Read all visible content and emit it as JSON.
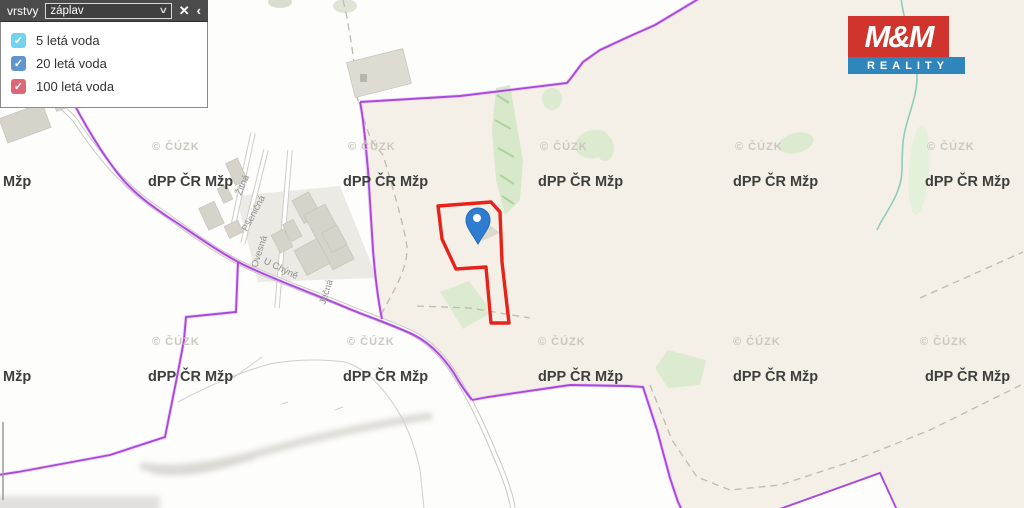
{
  "panel": {
    "title": "vrstvy",
    "dropdown": {
      "value": "záplav",
      "chevron": "∨"
    },
    "close_icon": "✕",
    "collapse_icon": "‹",
    "checkmark": "✓",
    "layers": [
      {
        "label": "5 letá voda",
        "checked": true,
        "color": "#72d3ee"
      },
      {
        "label": "20 letá voda",
        "checked": true,
        "color": "#6096cb"
      },
      {
        "label": "100 letá voda",
        "checked": true,
        "color": "#dd6777"
      }
    ]
  },
  "logo": {
    "top": "M&M",
    "bottom": "REALITY",
    "red": "#d0342c",
    "blue": "#2f86bd"
  },
  "map": {
    "watermark": "dPP ČR Mžp",
    "watermark_partial": "Mžp",
    "copyright": "© ČÚZK",
    "streets": {
      "zitna": "Žitná",
      "psenicna": "Pšeničná",
      "ovesna": "Ovesná",
      "uchyne": "U Chýně",
      "jecna": "Ječná"
    },
    "colors": {
      "field": "#f5f0e7",
      "boundary_purple": "#ab47dd",
      "parcel_outline_red": "#e8221b",
      "pin_blue": "#2e7dd1",
      "vegetation_green": "#d9e9cc",
      "stream_teal": "#8fccbc",
      "road_casing": "#c9c6c0",
      "building_gray": "#d6d3cb"
    }
  }
}
